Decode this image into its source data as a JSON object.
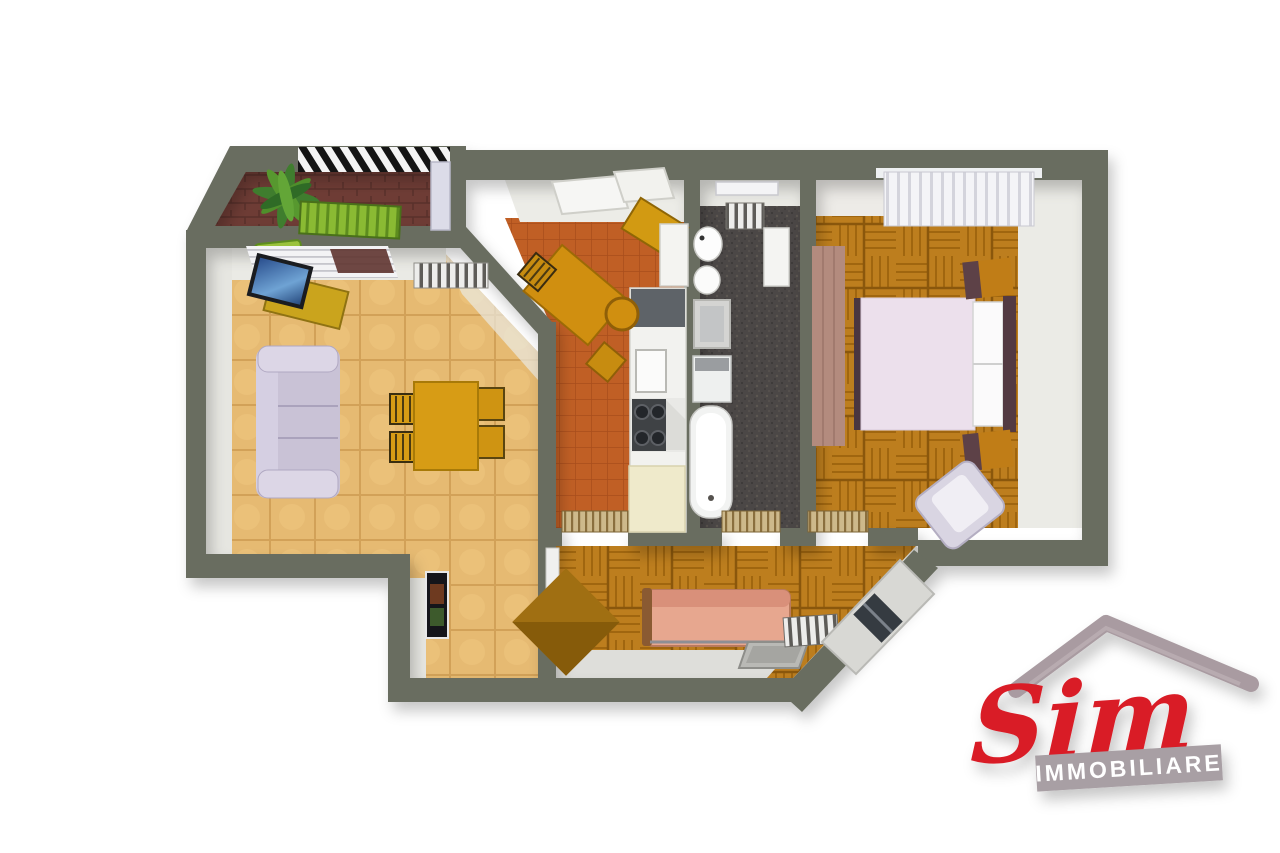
{
  "image": {
    "type": "3d-floor-plan-render",
    "description": "Top-down 3D render of a two-bedroom apartment with balcony"
  },
  "brand": {
    "name": "Sim",
    "tagline": "IMMOBILIARE",
    "script_color": "#d91b26",
    "banner_color": "#a89fa4",
    "banner_text_color": "#ffffff",
    "roof_color": "#a99ba1"
  },
  "palette": {
    "background": "#ffffff",
    "wall": "#696d60",
    "wall_face": "#ebebe6",
    "floor_living": "#e6ba72",
    "floor_kitchen": "#c05f25",
    "floor_bath": "#4b4746",
    "floor_parquet": "#bd7e1e",
    "floor_balcony": "#6e3c35",
    "sofa": "#c9c2d6",
    "dining_table": "#d79c15",
    "kitchen_table": "#d08f10",
    "counter": "#f2f2ef",
    "cream_cabinet": "#efeacb",
    "bed_duvet": "#ece0ec",
    "wardrobe": "#b38b7e",
    "nightstand": "#c07d17",
    "armchair": "#d9d5e2",
    "pink_sofa": "#e7a78f",
    "chest": "#a06f12",
    "outdoor_green": "#8aba33",
    "plant_green": "#3f7d2e",
    "tv_screen": "#3d6fae"
  },
  "rooms": [
    {
      "name": "balcony",
      "floor": "brick"
    },
    {
      "name": "living-room",
      "floor": "beige-tiles"
    },
    {
      "name": "kitchen",
      "floor": "terracotta-tiles"
    },
    {
      "name": "bathroom",
      "floor": "dark-stone"
    },
    {
      "name": "bedroom",
      "floor": "wood-parquet"
    },
    {
      "name": "second-bedroom",
      "floor": "wood-parquet"
    },
    {
      "name": "entry-hall",
      "floor": "beige-tiles"
    }
  ]
}
